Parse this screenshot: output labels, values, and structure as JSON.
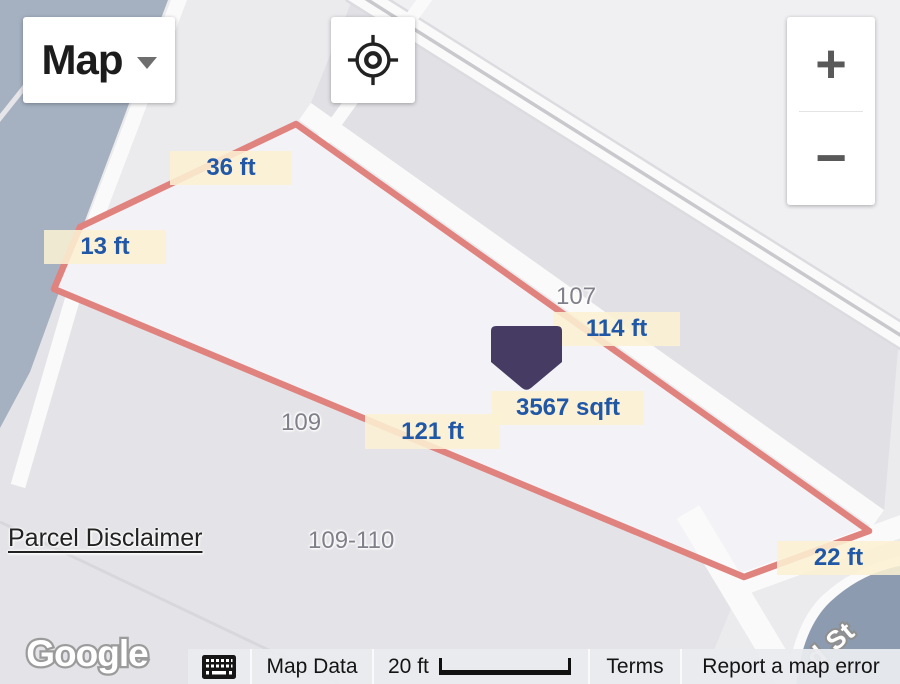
{
  "map_controls": {
    "map_type_label": "Map",
    "zoom_in_label": "+",
    "zoom_out_label": "−"
  },
  "parcel": {
    "area_label": "3567 sqft",
    "side_lengths": [
      "36 ft",
      "13 ft",
      "114 ft",
      "121 ft",
      "22 ft"
    ],
    "lot_numbers": [
      "107",
      "109",
      "109-110"
    ]
  },
  "overlays": {
    "parcel_disclaimer": "Parcel Disclaimer",
    "google_logo": "Google",
    "street_name": "d St"
  },
  "attribution_bar": {
    "map_data_label": "Map Data",
    "scale_label": "20 ft",
    "terms_label": "Terms",
    "report_error_label": "Report a map error"
  },
  "icons": {
    "locate": "crosshair-locate-icon",
    "keyboard": "keyboard-icon",
    "map_type_arrow": "triangle-down-icon",
    "marker": "parcel-marker-pin"
  },
  "colors": {
    "parcel_line": "#e0827e",
    "measurement_bg": "#faf0d3",
    "measurement_text": "#2057a6",
    "marker_fill": "#463c63",
    "water": "#a5b1c1",
    "water_dark": "#8c9bb0",
    "land": "#ebebee"
  }
}
